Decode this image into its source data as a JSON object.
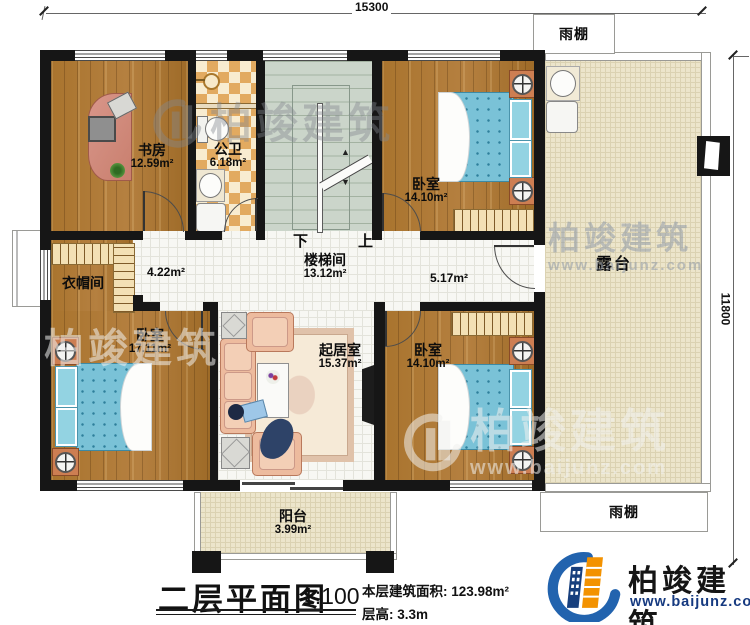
{
  "dimensions": {
    "top": "15300",
    "right": "11800"
  },
  "rooms": {
    "study": {
      "name": "书房",
      "area": "12.59m²"
    },
    "bath": {
      "name": "公卫",
      "area": "6.18m²"
    },
    "stairwell": {
      "name": "楼梯间",
      "area": "13.12m²"
    },
    "bedroom_top": {
      "name": "卧室",
      "area": "14.10m²"
    },
    "cloakroom": {
      "name": "衣帽间"
    },
    "bedroom_left": {
      "name": "卧室",
      "area": "17.11m²"
    },
    "living": {
      "name": "起居室",
      "area": "15.37m²"
    },
    "bedroom_right": {
      "name": "卧室",
      "area": "14.10m²"
    },
    "terrace": {
      "name": "露台"
    },
    "balcony": {
      "name": "阳台",
      "area": "3.99m²"
    }
  },
  "halls": {
    "left_area": "4.22m²",
    "right_area": "5.17m²"
  },
  "canopy": {
    "top": "雨棚",
    "bottom": "雨棚"
  },
  "stairs": {
    "down": "下",
    "up": "上"
  },
  "titleblock": {
    "title": "二层平面图",
    "scale": "1:100",
    "area_line": "本层建筑面积: 123.98m²",
    "height_line": "层高: 3.3m"
  },
  "logo": {
    "name": "柏竣建筑",
    "url": "www.baijunz.com"
  },
  "watermark": {
    "name": "柏竣建筑",
    "url": "www.baijunz.com"
  }
}
